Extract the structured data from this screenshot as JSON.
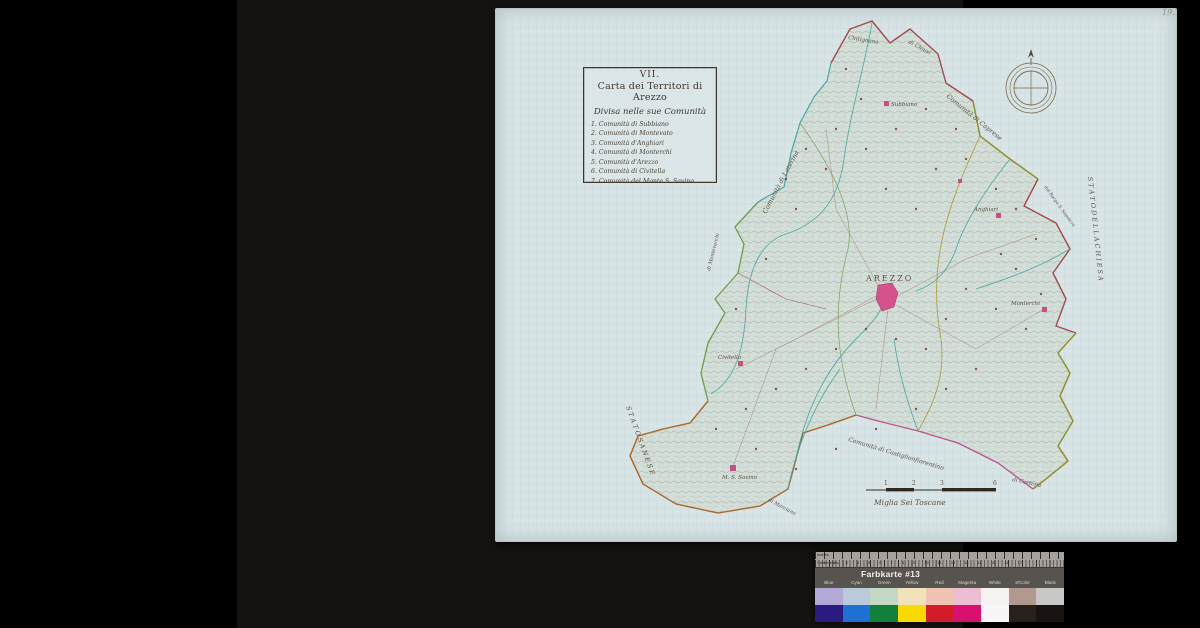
{
  "page": {
    "number_annotation": "19."
  },
  "map": {
    "cartouche": {
      "number": "VII.",
      "title": "Carta dei Territori di Arezzo",
      "subtitle": "Divisa nelle sue Comunità",
      "communities": [
        "1. Comunità di Subbiano",
        "2. Comunità di Montevato",
        "3. Comunità d'Anghiari",
        "4. Comunità di Monterchi",
        "5. Comunità d'Arezzo",
        "6. Comunità di Civitella",
        "7. Comunità del Monte S. Savino"
      ]
    },
    "towns": {
      "arezzo": "AREZZO",
      "subbiano": "Subbiano",
      "anghiari": "Anghiari",
      "monterchi": "Monterchi",
      "civitella": "Civitella",
      "monte_s_savino": "M. S. Savino"
    },
    "edge_labels": {
      "laterina": "Comunità di Laterina",
      "montevarchi": "di Montevarchi",
      "chitignano": "Chitignano",
      "chiusi": "di Chiusi",
      "caprese": "Comunità di Caprese",
      "borgo": "del Borgo S. Sepolcro",
      "stato_chiesa": "S T A T O   D E L L A   C H I E S A",
      "stato_sanese": "S T A T O   S A N E S E",
      "castiglion": "Comunità di Castiglionfiorentino",
      "cortona": "di Cortona",
      "marciano": "di Marciano"
    },
    "scale_bar": {
      "tick1": "1",
      "tick2": "2",
      "tick3": "3",
      "tick6": "6",
      "caption": "Miglia Sei Toscane"
    }
  },
  "color_card": {
    "title": "Farbkarte #13",
    "ruler": {
      "top_unit": "Inches",
      "bottom_unit": "Centimeters",
      "numbers_row": "1 2 3 4 5 6 7 8 9 10 11 12 13 14 15 16 17"
    },
    "columns": [
      {
        "label": "Blue",
        "tint": "#b3a9d6",
        "solid": "#2b1b80"
      },
      {
        "label": "Cyan",
        "tint": "#b9cadb",
        "solid": "#1e70d2"
      },
      {
        "label": "Green",
        "tint": "#c3d8c5",
        "solid": "#12803a"
      },
      {
        "label": "Yellow",
        "tint": "#f1e2bb",
        "solid": "#f8da00"
      },
      {
        "label": "Red",
        "tint": "#f1c3b2",
        "solid": "#d41b2a"
      },
      {
        "label": "Magenta",
        "tint": "#edbdd3",
        "solid": "#d8106f"
      },
      {
        "label": "White",
        "tint": "#f7f2f2",
        "solid": "#faf5f7"
      },
      {
        "label": "3/Color",
        "tint": "#b1998f",
        "solid": "#27201d"
      },
      {
        "label": "Black",
        "tint": "#c8c8c6",
        "solid": "#191411"
      }
    ]
  }
}
